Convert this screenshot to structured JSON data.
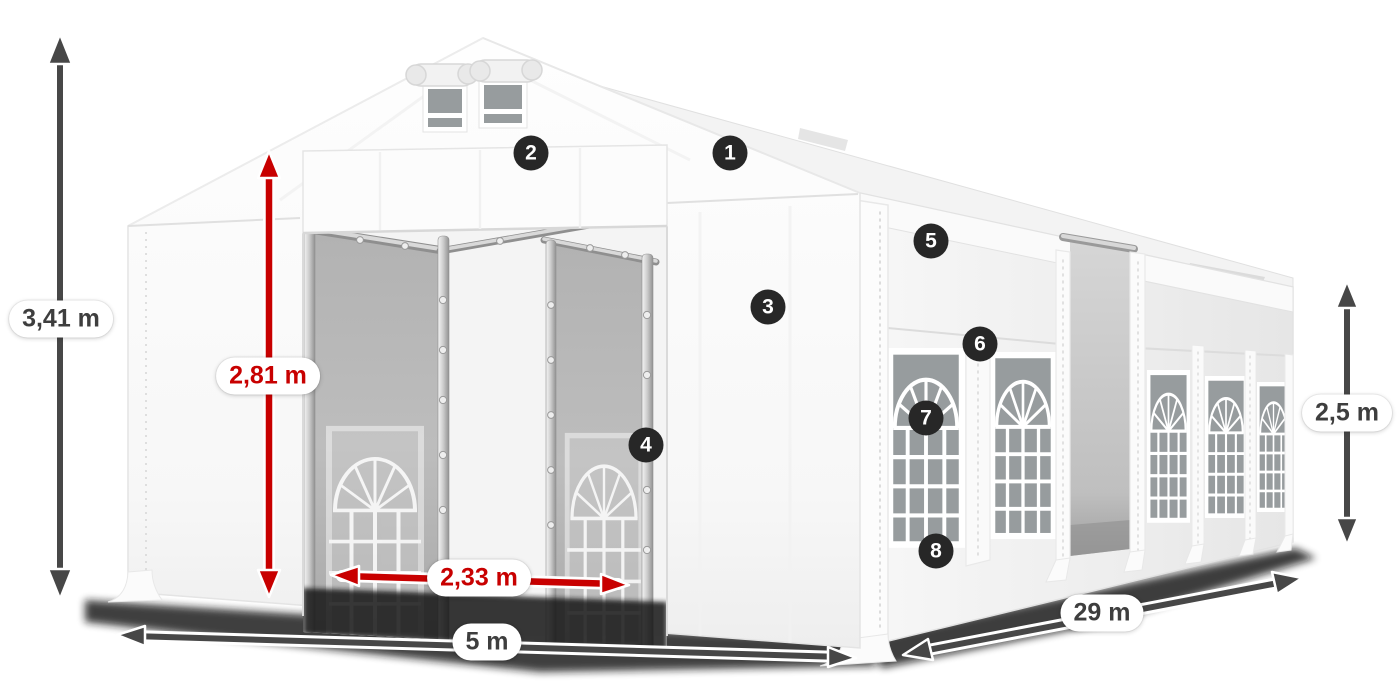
{
  "page": {
    "title": "Party tent dimensions diagram",
    "background": "#ffffff"
  },
  "colors": {
    "accent_red": "#c80000",
    "dimension_gray": "#474747",
    "badge_bg": "#272727",
    "badge_text": "#ffffff",
    "pill_bg": "#ffffff",
    "pill_text": "#3e3e3e",
    "glass_gray": "#979c9e"
  },
  "dimensions": {
    "total_height": {
      "label": "3,41 m",
      "style": "gray",
      "orientation": "vertical",
      "position": "far-left"
    },
    "entrance_height": {
      "label": "2,81 m",
      "style": "red",
      "orientation": "vertical",
      "position": "front-entrance"
    },
    "entrance_width": {
      "label": "2,33 m",
      "style": "red",
      "orientation": "horizontal",
      "position": "inner-door"
    },
    "front_width": {
      "label": "5 m",
      "style": "gray",
      "orientation": "horizontal",
      "position": "front-bottom"
    },
    "side_length": {
      "label": "29 m",
      "style": "gray",
      "orientation": "diagonal",
      "position": "side-bottom"
    },
    "side_wall_height": {
      "label": "2,5 m",
      "style": "gray",
      "orientation": "vertical",
      "position": "far-right"
    }
  },
  "callouts": [
    {
      "label": "1",
      "location": "roof-right-slope"
    },
    {
      "label": "2",
      "location": "front-header-panel"
    },
    {
      "label": "3",
      "location": "front-right-wall"
    },
    {
      "label": "4",
      "location": "inner-door-post"
    },
    {
      "label": "5",
      "location": "side-wall-upper-panel"
    },
    {
      "label": "6",
      "location": "side-wall-mid-panel"
    },
    {
      "label": "7",
      "location": "side-window"
    },
    {
      "label": "8",
      "location": "side-wall-lower-panel"
    }
  ]
}
